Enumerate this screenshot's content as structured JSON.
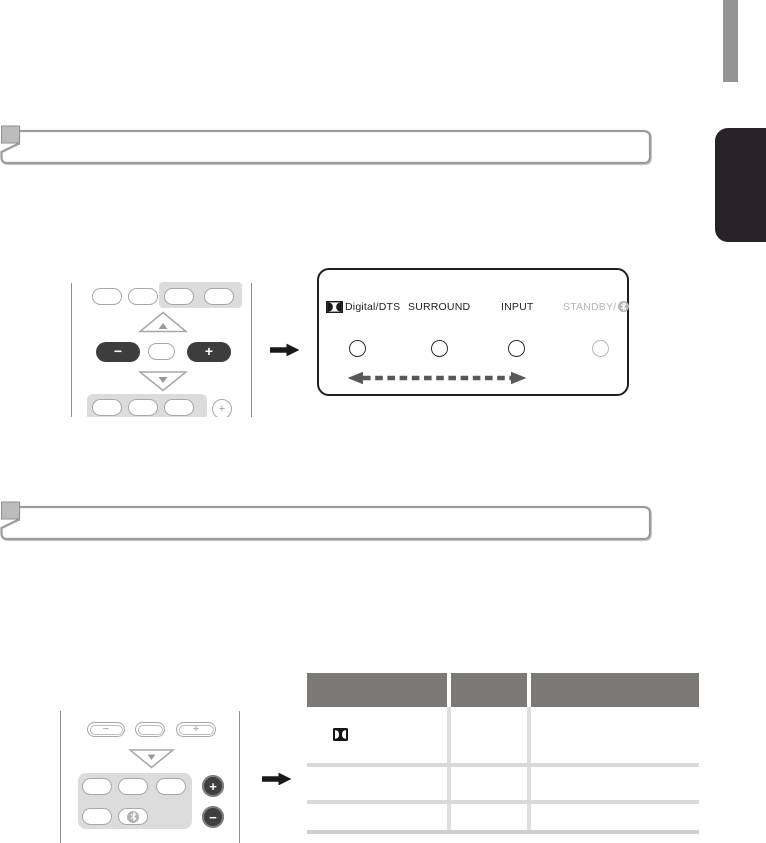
{
  "indicator_panel": {
    "label_dolby": "Digital/DTS",
    "label_surround": "SURROUND",
    "label_input": "INPUT",
    "label_standby": "STANDBY/",
    "indicators": [
      "dolby-digital-dts-led",
      "surround-led",
      "input-led",
      "standby-bluetooth-led"
    ],
    "text_color": "#1f1f1f",
    "standby_color": "#b5b5b5"
  },
  "remote_top": {
    "minus_button": "−",
    "plus_button": "+",
    "small_plus_button": "+"
  },
  "remote_bottom": {
    "minus_button": "−",
    "plus_button": "+",
    "volume_plus_button": "+",
    "volume_minus_button": "−",
    "bluetooth_button_icon": "bluetooth-icon"
  },
  "arrows": {
    "solid": "right-arrow",
    "dashed": "left-right-dashed-arrow"
  },
  "table": {
    "column_count": 3,
    "row_count": 3,
    "header_labels": [
      "",
      "",
      ""
    ],
    "row1_col1_icon": "dolby-digital-icon",
    "header_color": "#7b7878"
  },
  "colors": {
    "tab_black": "#272326",
    "tab_gray": "#949494",
    "panel_border": "#1f1f1f",
    "button_dark": "#3d3d3d",
    "outline_gray": "#a8a8a8",
    "patch_gray": "#dcdcdc",
    "banner_border": "#9b9b9b"
  }
}
